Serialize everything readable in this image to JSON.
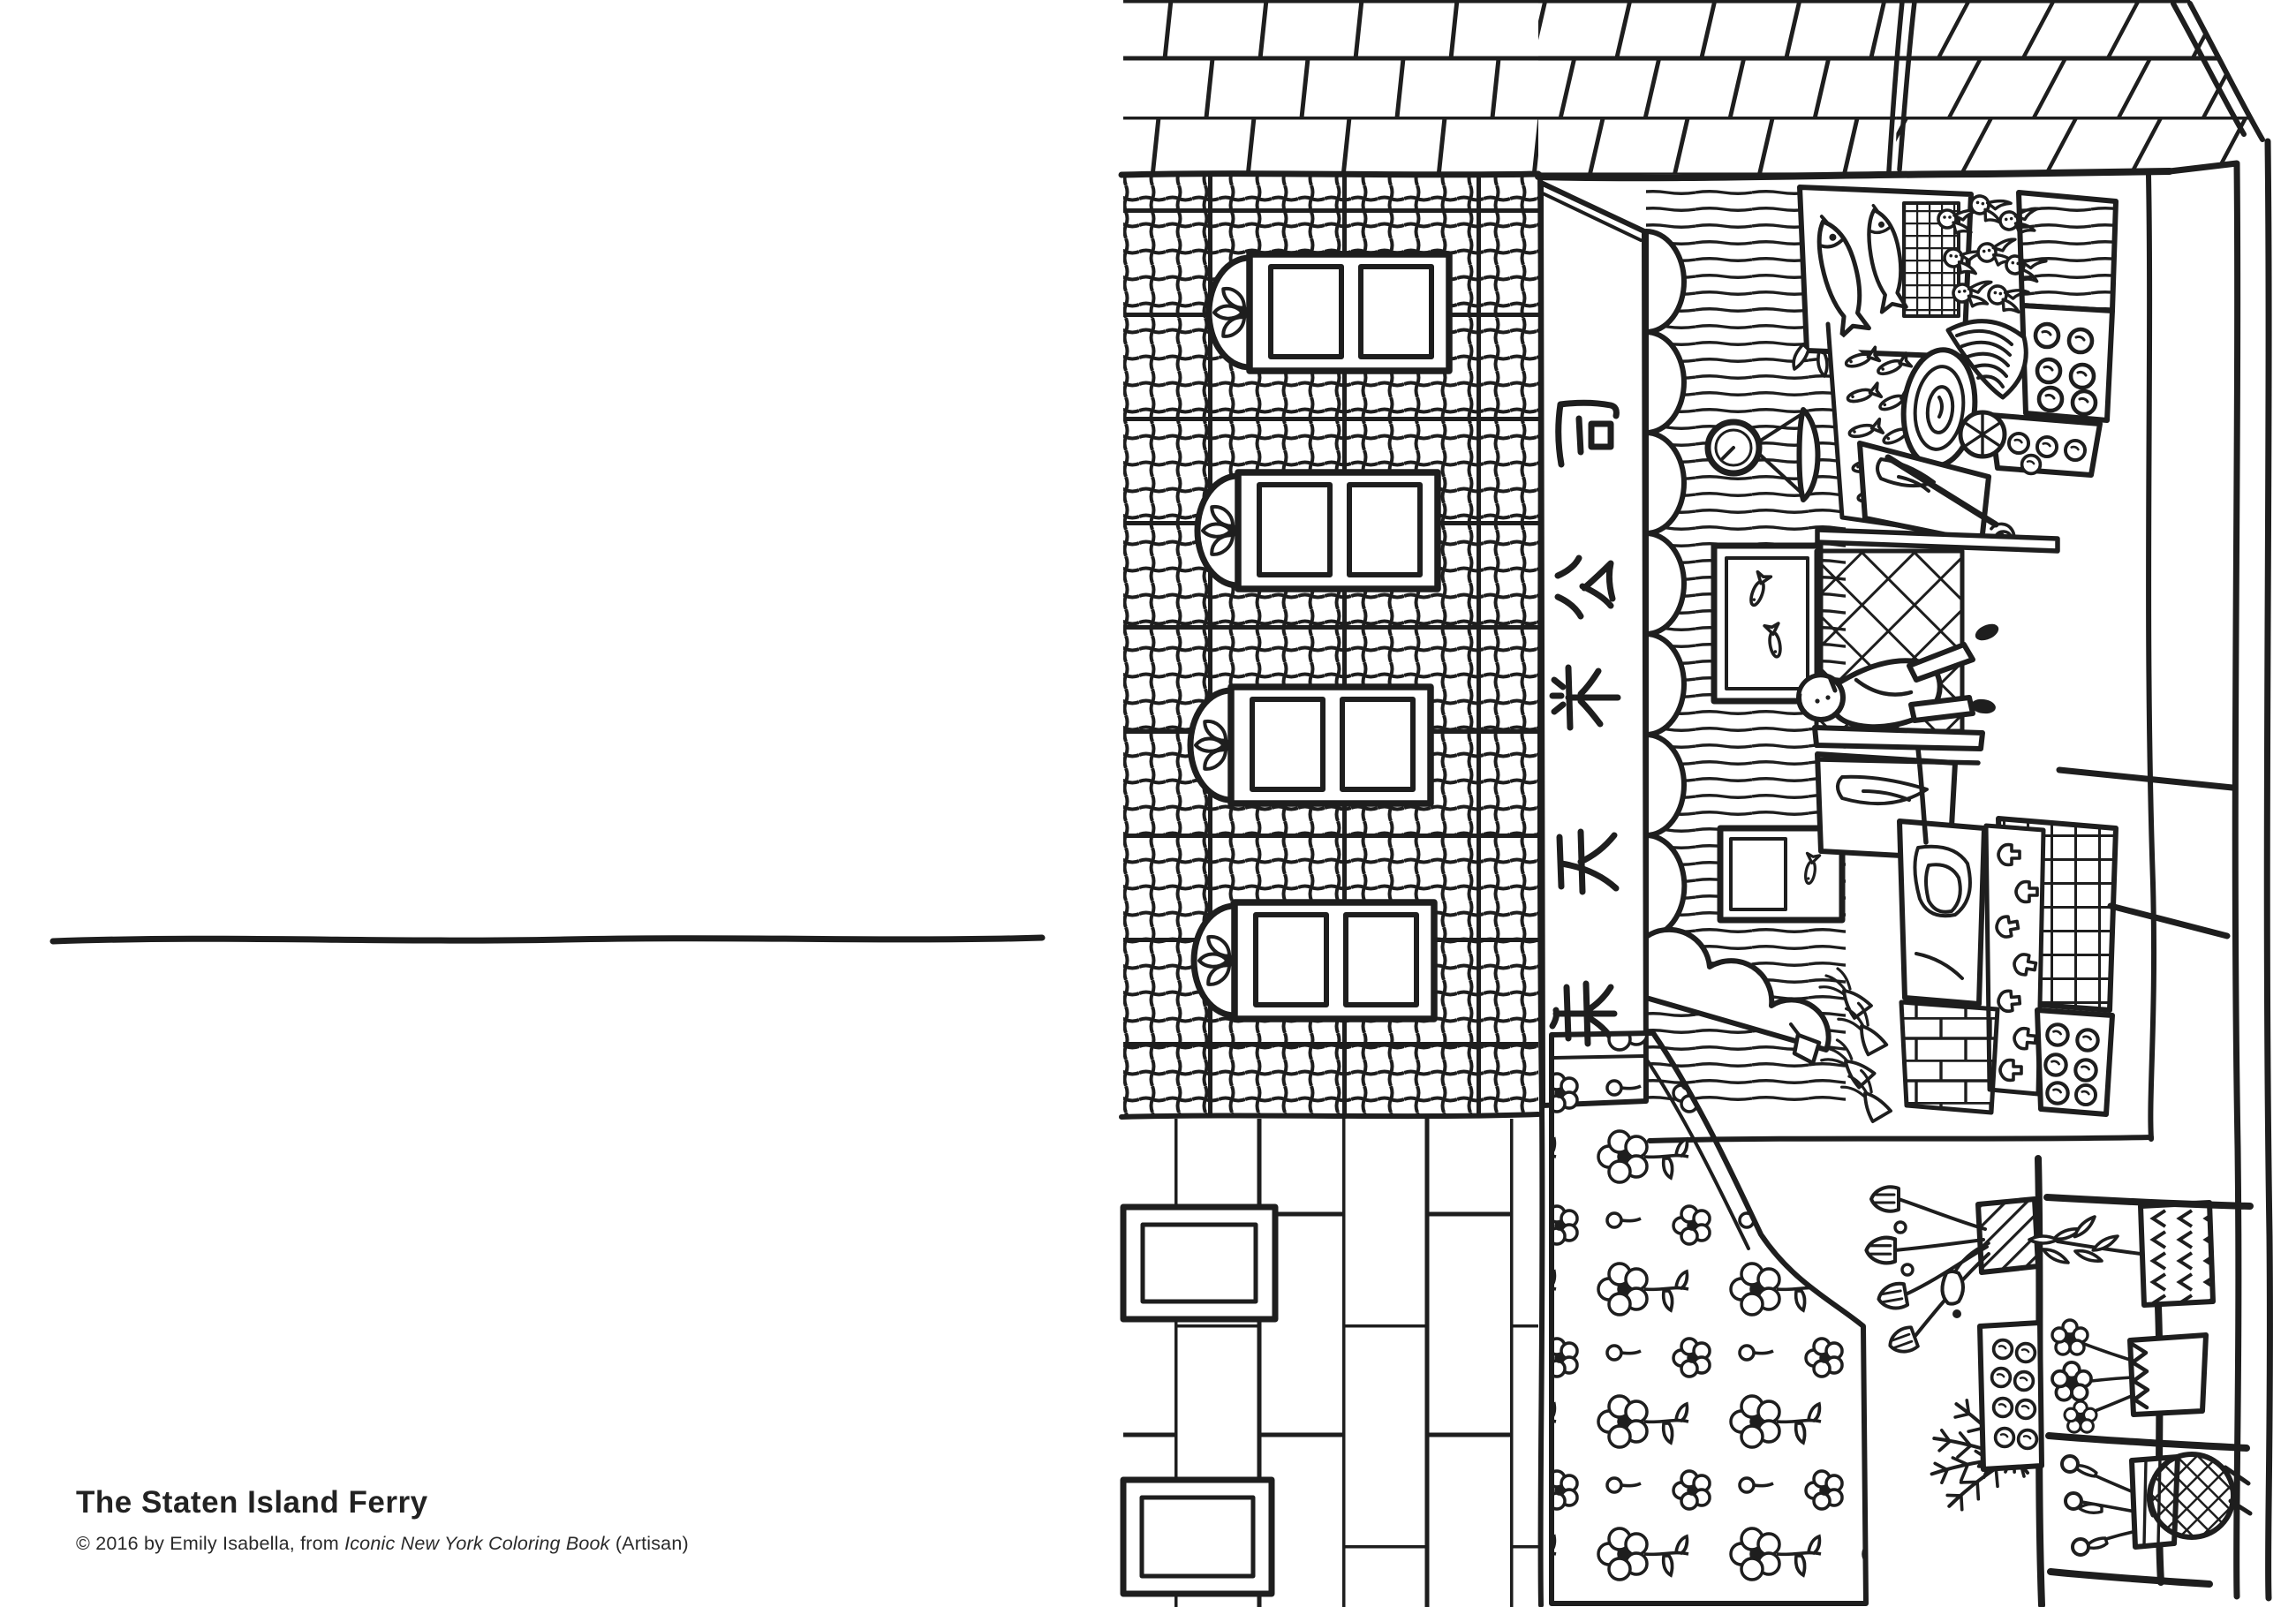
{
  "left_page": {
    "title": "The Staten Island Ferry",
    "credit_prefix": "© 2016 by Emily Isabella, from ",
    "credit_book_title": "Iconic New York Coloring Book",
    "credit_suffix": " (Artisan)",
    "divider": "hand-drawn horizontal rule"
  },
  "right_page": {
    "alt": "Black-and-white coloring book line drawing of a Chinatown market storefront, rotated 90 degrees counter-clockwise on the page",
    "sign_glyphs": [
      "司",
      "公",
      "采",
      "天",
      "朱"
    ],
    "ink_color": "#1e1e1e",
    "paper_color": "#ffffff"
  }
}
